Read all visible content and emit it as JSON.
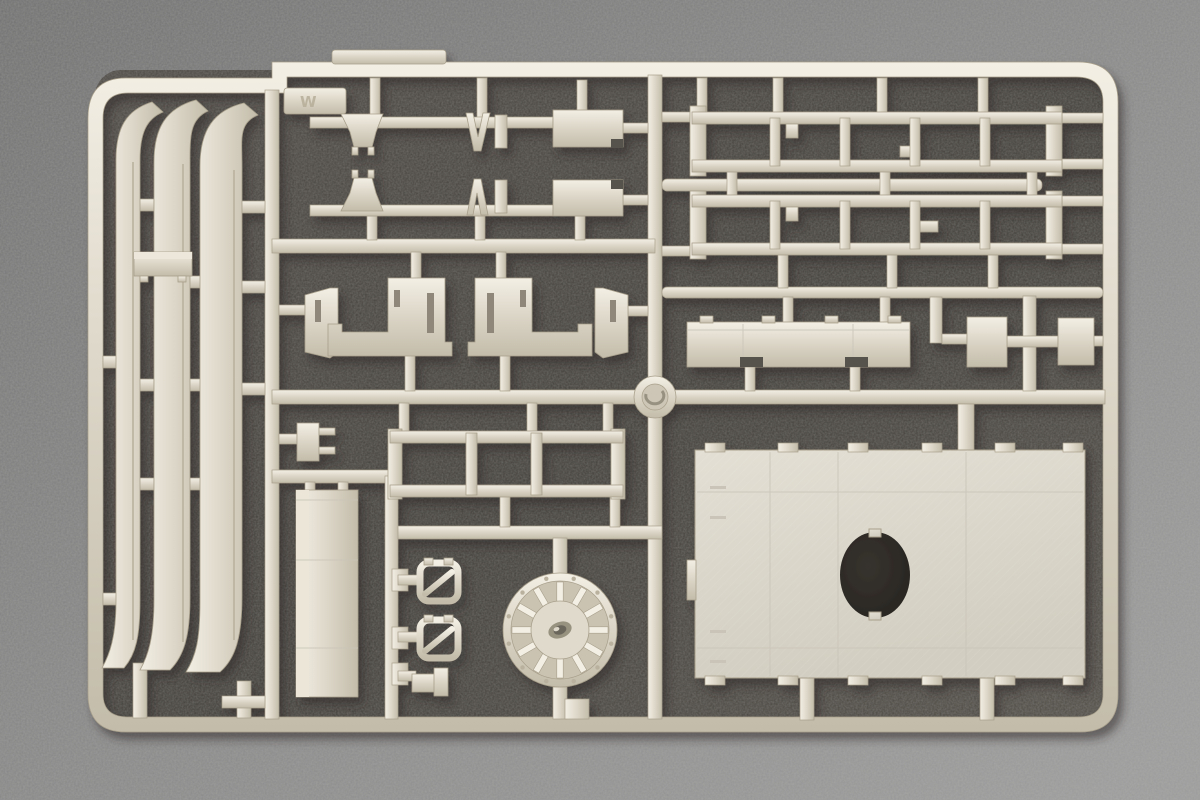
{
  "scene": {
    "description": "Injection-molded light-grey styrene model kit sprue photographed on a dark grey speckled backdrop",
    "sprue_tab_marking": "W",
    "visible_text_elsewhere": ""
  },
  "colors": {
    "bg": "#868686",
    "bg_light": "#9a9a9a",
    "bg_dark": "#6f6f6f",
    "interior_dark": "#4b4742",
    "interior_dark2": "#413e39",
    "plastic_light": "#f3efe4",
    "plastic_mid": "#ddd7c9",
    "plastic_dark": "#c3bcaa",
    "edge": "#a89f8b",
    "ridge": "#b9b19e",
    "slot": "#8f887a",
    "notch": "#57534d",
    "seam": "#c9c4b7",
    "panel_face": "#dedacf",
    "emboss": "#b7ae99",
    "shadow": "#2e2b27"
  },
  "sprue": {
    "ladders": {
      "rung_xs": [
        775,
        845,
        915,
        985
      ],
      "rows": [
        {
          "top": 112,
          "bottom": 172
        },
        {
          "top": 195,
          "bottom": 255
        }
      ]
    },
    "wheel": {
      "cx": 560,
      "cy": 630,
      "outer_r": 57,
      "ring_r": 49,
      "hub_r": 29,
      "spokes": 12,
      "rim_dots": 12
    },
    "panel": {
      "x": 695,
      "y": 450,
      "w": 390,
      "h": 228,
      "teeth_xs": [
        705,
        778,
        848,
        922,
        995,
        1063
      ],
      "hole": {
        "cx": 875,
        "cy": 575,
        "rx": 35,
        "ry": 43
      }
    },
    "gates_v": [
      [
        370,
        78,
        10,
        40
      ],
      [
        477,
        78,
        10,
        40
      ],
      [
        577,
        80,
        10,
        32
      ],
      [
        367,
        216,
        10,
        24
      ],
      [
        475,
        216,
        10,
        24
      ],
      [
        575,
        216,
        10,
        24
      ],
      [
        411,
        252,
        10,
        27
      ],
      [
        496,
        252,
        10,
        27
      ],
      [
        405,
        355,
        10,
        36
      ],
      [
        500,
        355,
        10,
        36
      ],
      [
        399,
        403,
        10,
        29
      ],
      [
        527,
        403,
        10,
        29
      ],
      [
        603,
        403,
        10,
        29
      ],
      [
        500,
        496,
        10,
        31
      ],
      [
        610,
        496,
        10,
        31
      ],
      [
        553,
        538,
        14,
        37
      ],
      [
        553,
        687,
        14,
        32
      ],
      [
        565,
        699,
        24,
        20
      ],
      [
        133,
        663,
        14,
        55
      ],
      [
        237,
        681,
        14,
        37
      ],
      [
        305,
        482,
        10,
        10
      ],
      [
        338,
        482,
        10,
        10
      ],
      [
        697,
        78,
        10,
        35
      ],
      [
        773,
        78,
        10,
        35
      ],
      [
        877,
        78,
        10,
        35
      ],
      [
        978,
        78,
        10,
        35
      ],
      [
        727,
        171,
        10,
        29
      ],
      [
        880,
        171,
        10,
        29
      ],
      [
        1027,
        171,
        10,
        29
      ],
      [
        778,
        254,
        10,
        34
      ],
      [
        887,
        254,
        10,
        34
      ],
      [
        988,
        254,
        10,
        34
      ],
      [
        783,
        297,
        10,
        26
      ],
      [
        880,
        297,
        10,
        26
      ],
      [
        745,
        366,
        10,
        25
      ],
      [
        850,
        366,
        10,
        25
      ],
      [
        930,
        297,
        12,
        46
      ],
      [
        958,
        404,
        16,
        47
      ],
      [
        800,
        676,
        14,
        44
      ],
      [
        980,
        676,
        14,
        44
      ],
      [
        392,
        569,
        16,
        22
      ],
      [
        392,
        627,
        16,
        22
      ],
      [
        392,
        663,
        16,
        22
      ]
    ],
    "gates_h": [
      [
        279,
        305,
        26,
        10
      ],
      [
        628,
        306,
        20,
        10
      ],
      [
        623,
        123,
        25,
        10
      ],
      [
        623,
        195,
        25,
        10
      ],
      [
        662,
        112,
        30,
        10
      ],
      [
        662,
        246,
        30,
        10
      ],
      [
        1062,
        113,
        41,
        10
      ],
      [
        1062,
        159,
        41,
        10
      ],
      [
        1062,
        196,
        41,
        10
      ],
      [
        1062,
        244,
        41,
        10
      ],
      [
        942,
        334,
        25,
        10
      ],
      [
        1093,
        336,
        10,
        10
      ],
      [
        1007,
        336,
        51,
        11
      ],
      [
        279,
        434,
        18,
        10
      ],
      [
        398,
        575,
        22,
        10
      ],
      [
        398,
        632,
        22,
        10
      ],
      [
        398,
        671,
        18,
        10
      ],
      [
        103,
        356,
        15,
        12
      ],
      [
        103,
        593,
        15,
        12
      ],
      [
        133,
        199,
        21,
        12
      ],
      [
        133,
        379,
        21,
        12
      ],
      [
        133,
        478,
        21,
        12
      ],
      [
        188,
        276,
        14,
        12
      ],
      [
        188,
        379,
        14,
        12
      ],
      [
        188,
        478,
        14,
        12
      ],
      [
        236,
        201,
        29,
        12
      ],
      [
        230,
        281,
        35,
        12
      ],
      [
        222,
        383,
        43,
        12
      ],
      [
        222,
        696,
        43,
        12
      ]
    ]
  }
}
